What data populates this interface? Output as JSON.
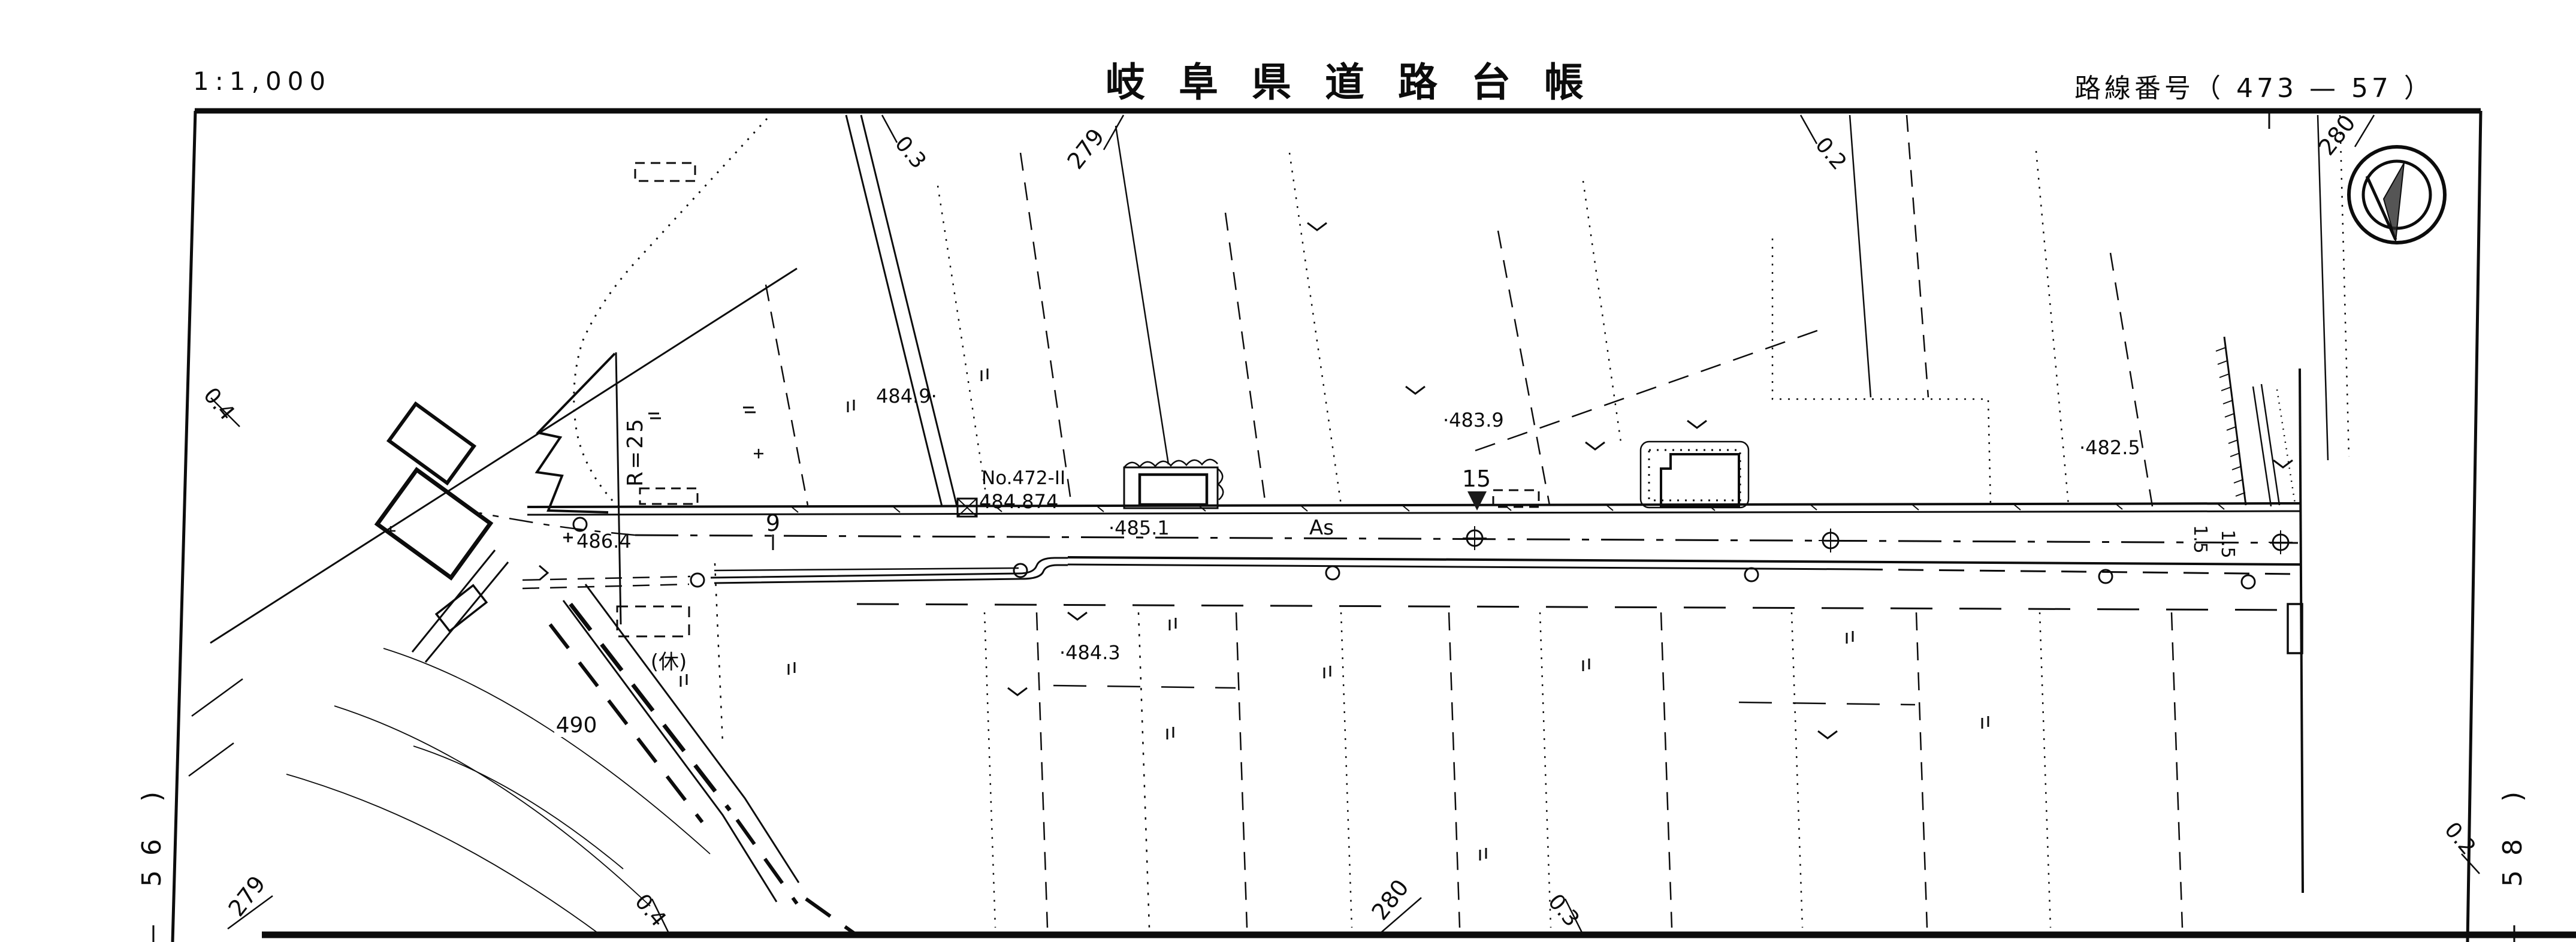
{
  "header": {
    "scale": "1:1,000",
    "title": "岐阜県道路台帳",
    "route_label": "路線番号（ 473 — 57 ）"
  },
  "road": {
    "surface": "As",
    "center_elev": "·485.1",
    "station_9": "9",
    "station_15": "15",
    "width_a": "1.5",
    "width_b": "1.5",
    "bm_no": "No.472-II",
    "bm_elev": "484.874"
  },
  "elev": {
    "e4849": "484.9·",
    "e4839": "·483.9",
    "e4825": "·482.5",
    "e4843": "·484.3",
    "e4864": "486.4"
  },
  "misc": {
    "radius": "R=25",
    "fallow": "(休)",
    "contour490": "490"
  },
  "edges": {
    "top": [
      "0.3",
      "279",
      "0.2",
      "280"
    ],
    "bottom": [
      "279",
      "0.4",
      "280",
      "0.3"
    ],
    "left": [
      "0.4"
    ],
    "right": [
      "0.2"
    ],
    "sheet_left": "— 56  )",
    "sheet_right": "— 58  )"
  }
}
